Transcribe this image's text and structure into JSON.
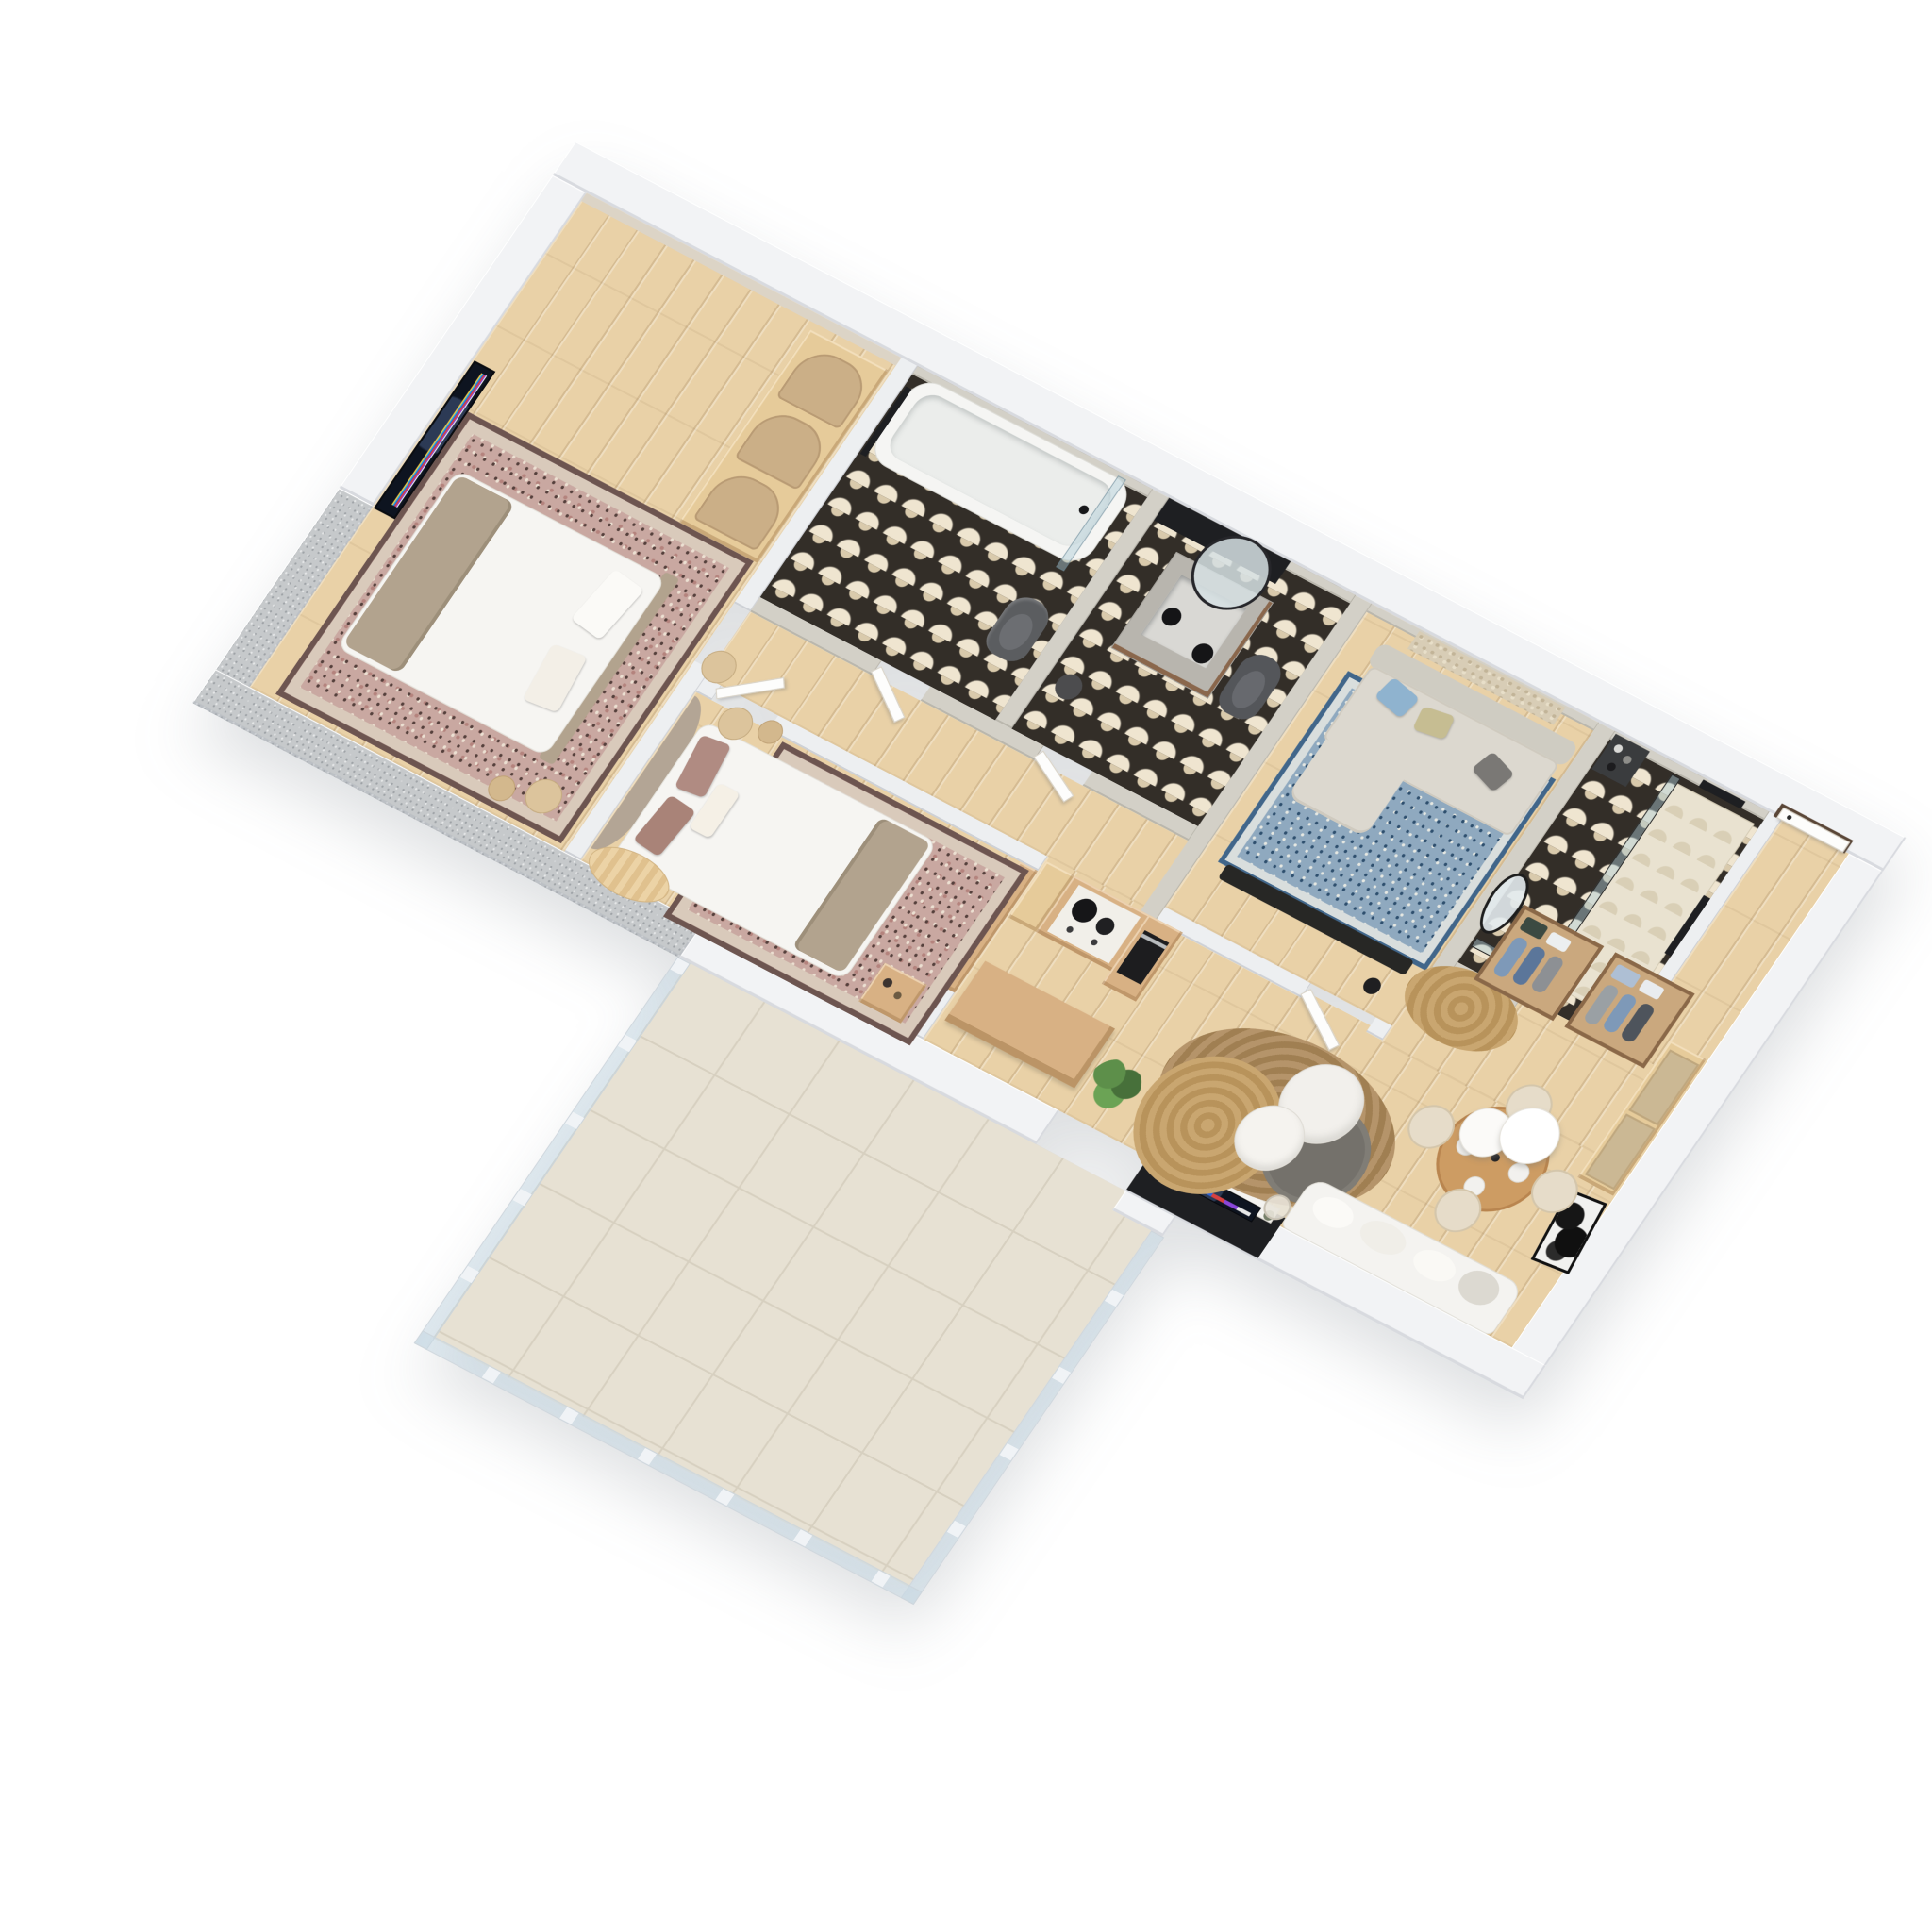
{
  "scene": {
    "type": "isometric-3d-floor-plan-render",
    "background": "#ffffff",
    "visible_text": "none",
    "palette": {
      "wall_white": "#f2f3f5",
      "wall_cut_concrete": "#c6c9cb",
      "wall_limewash_concrete": "#d3d0c7",
      "accent_black": "#1e1f22",
      "floor_wood_oak": "#e9d1a7",
      "bath_tile_dark": "#332e28",
      "bath_tile_cream": "#efe5d0",
      "balcony_tile": "#e7e1d3",
      "oak_furniture": "#d8b184",
      "walnut_rack": "#8a6848",
      "sofa_gray": "#dbd7cd",
      "sofa_white_boucle": "#f6f5f2",
      "pillow_blue": "#8fb3cf",
      "pillow_olive": "#c6bd92",
      "pillow_charcoal": "#7a7875",
      "pillow_mauve": "#b08b82",
      "rug_blush": "#c9a8a1",
      "rug_persian_blue": "#8fa9bf",
      "rug_jute": "#c9a670",
      "rug_graphite": "#74716b",
      "sanitary_white": "#f6f6f4",
      "toilet_graphite": "#5b5d60",
      "glass": "#aac7d4"
    },
    "tv_app_row_colors": [
      "#f5c542",
      "#36b8cf",
      "#2f63d6",
      "#d64040",
      "#8a46d9"
    ]
  },
  "rooms": [
    {
      "id": "bedroom-1",
      "name": "Bedroom 1",
      "floor": "oak wood",
      "furniture": [
        "wall-mounted smart TV with colorful app row",
        "double bed with white duvet and taupe blanket",
        "blush ornate area rug",
        "arched oak wardrobe with three rattan doors",
        "round beige side tables with stick candles"
      ]
    },
    {
      "id": "bathroom",
      "name": "Bathroom",
      "floor": "black & cream fan-pattern tile",
      "furniture": [
        "white bathtub with glass screen",
        "black towel rail",
        "graphite wall-hung toilet",
        "limewash concrete walls"
      ]
    },
    {
      "id": "wc-vanity",
      "name": "WC / Vanity room",
      "floor": "black & cream fan-pattern tile",
      "furniture": [
        "black accent wall niche",
        "concrete vanity with basin",
        "arched leaning mirror",
        "two black globe pendant lights",
        "graphite wall-hung toilet",
        "dark round stool"
      ]
    },
    {
      "id": "sitting-room",
      "name": "Second lounge / study",
      "floor": "oak wood + persian blue rug",
      "furniture": [
        "gray sofa with chaise",
        "pillows blue / olive / charcoal",
        "black low media bench",
        "textured beige wall hanging",
        "black floor lamp"
      ]
    },
    {
      "id": "shower-room",
      "name": "Shower room",
      "floor": "black & cream fan-pattern tile",
      "furniture": [
        "walk-in glass shower with black frame",
        "black rain shower fixture",
        "dark corner shelf with toiletries",
        "dark towel on wall"
      ]
    },
    {
      "id": "bedroom-2",
      "name": "Bedroom 2",
      "floor": "oak wood",
      "furniture": [
        "curved taupe upholstered headboard",
        "double bed with white duvet and mauve pillows",
        "blush ornate area rug",
        "two round beige side tables",
        "oak nightstand with decanters",
        "curved oak bench"
      ]
    },
    {
      "id": "kitchen",
      "name": "Kitchen",
      "floor": "oak wood",
      "furniture": [
        "oak cabinetry run",
        "white counter with black pots on hob",
        "tall oak column with black built-in oven",
        "long oak island"
      ]
    },
    {
      "id": "living-dining",
      "name": "Living / dining room",
      "floor": "oak wood",
      "furniture": [
        "round oak dining table with tableware",
        "four cream barrel chairs",
        "two white globe pendant lamps",
        "black & white art frame leaning on wall",
        "oak wardrobe with two frosted doors",
        "two walnut clothes racks with boxes and hanging clothes",
        "oval jute entry rug",
        "organic black-framed mirror",
        "white entry door with walnut frame",
        "black media niche with floating console, smart TV and green vases",
        "fiddle-leaf plant",
        "layered jute rugs and graphite round rug",
        "two white pedestal coffee tables",
        "white boucle sofa",
        "glass tripod floor lamp"
      ]
    },
    {
      "id": "balcony",
      "name": "Balcony",
      "floor": "large stone tiles",
      "furniture": [
        "glass railing with white posts"
      ]
    }
  ]
}
